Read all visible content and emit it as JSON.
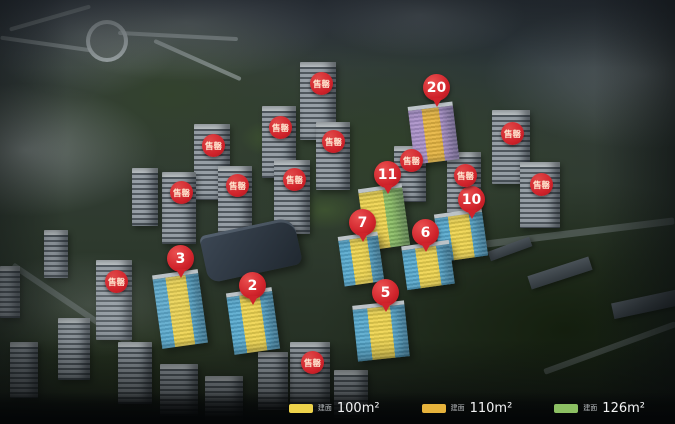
{
  "palette": {
    "red": "#d0232b",
    "yellow": "#eed34b",
    "orange": "#e6b33c",
    "green": "#8cc063",
    "blue": "#55a8cd",
    "purple": "#a98fc7",
    "badgeText": "#ffe6d0"
  },
  "markers": {
    "sold_out_label": "售罄",
    "pins": [
      {
        "label": "20"
      },
      {
        "label": "11"
      },
      {
        "label": "10"
      },
      {
        "label": "7"
      },
      {
        "label": "6"
      },
      {
        "label": "5"
      },
      {
        "label": "3"
      },
      {
        "label": "2"
      }
    ]
  },
  "legend": {
    "area_prefix": "建面",
    "items": [
      {
        "label": "100m²",
        "color_key": "yellow"
      },
      {
        "label": "110m²",
        "color_key": "orange"
      },
      {
        "label": "126m²",
        "color_key": "green"
      }
    ]
  }
}
